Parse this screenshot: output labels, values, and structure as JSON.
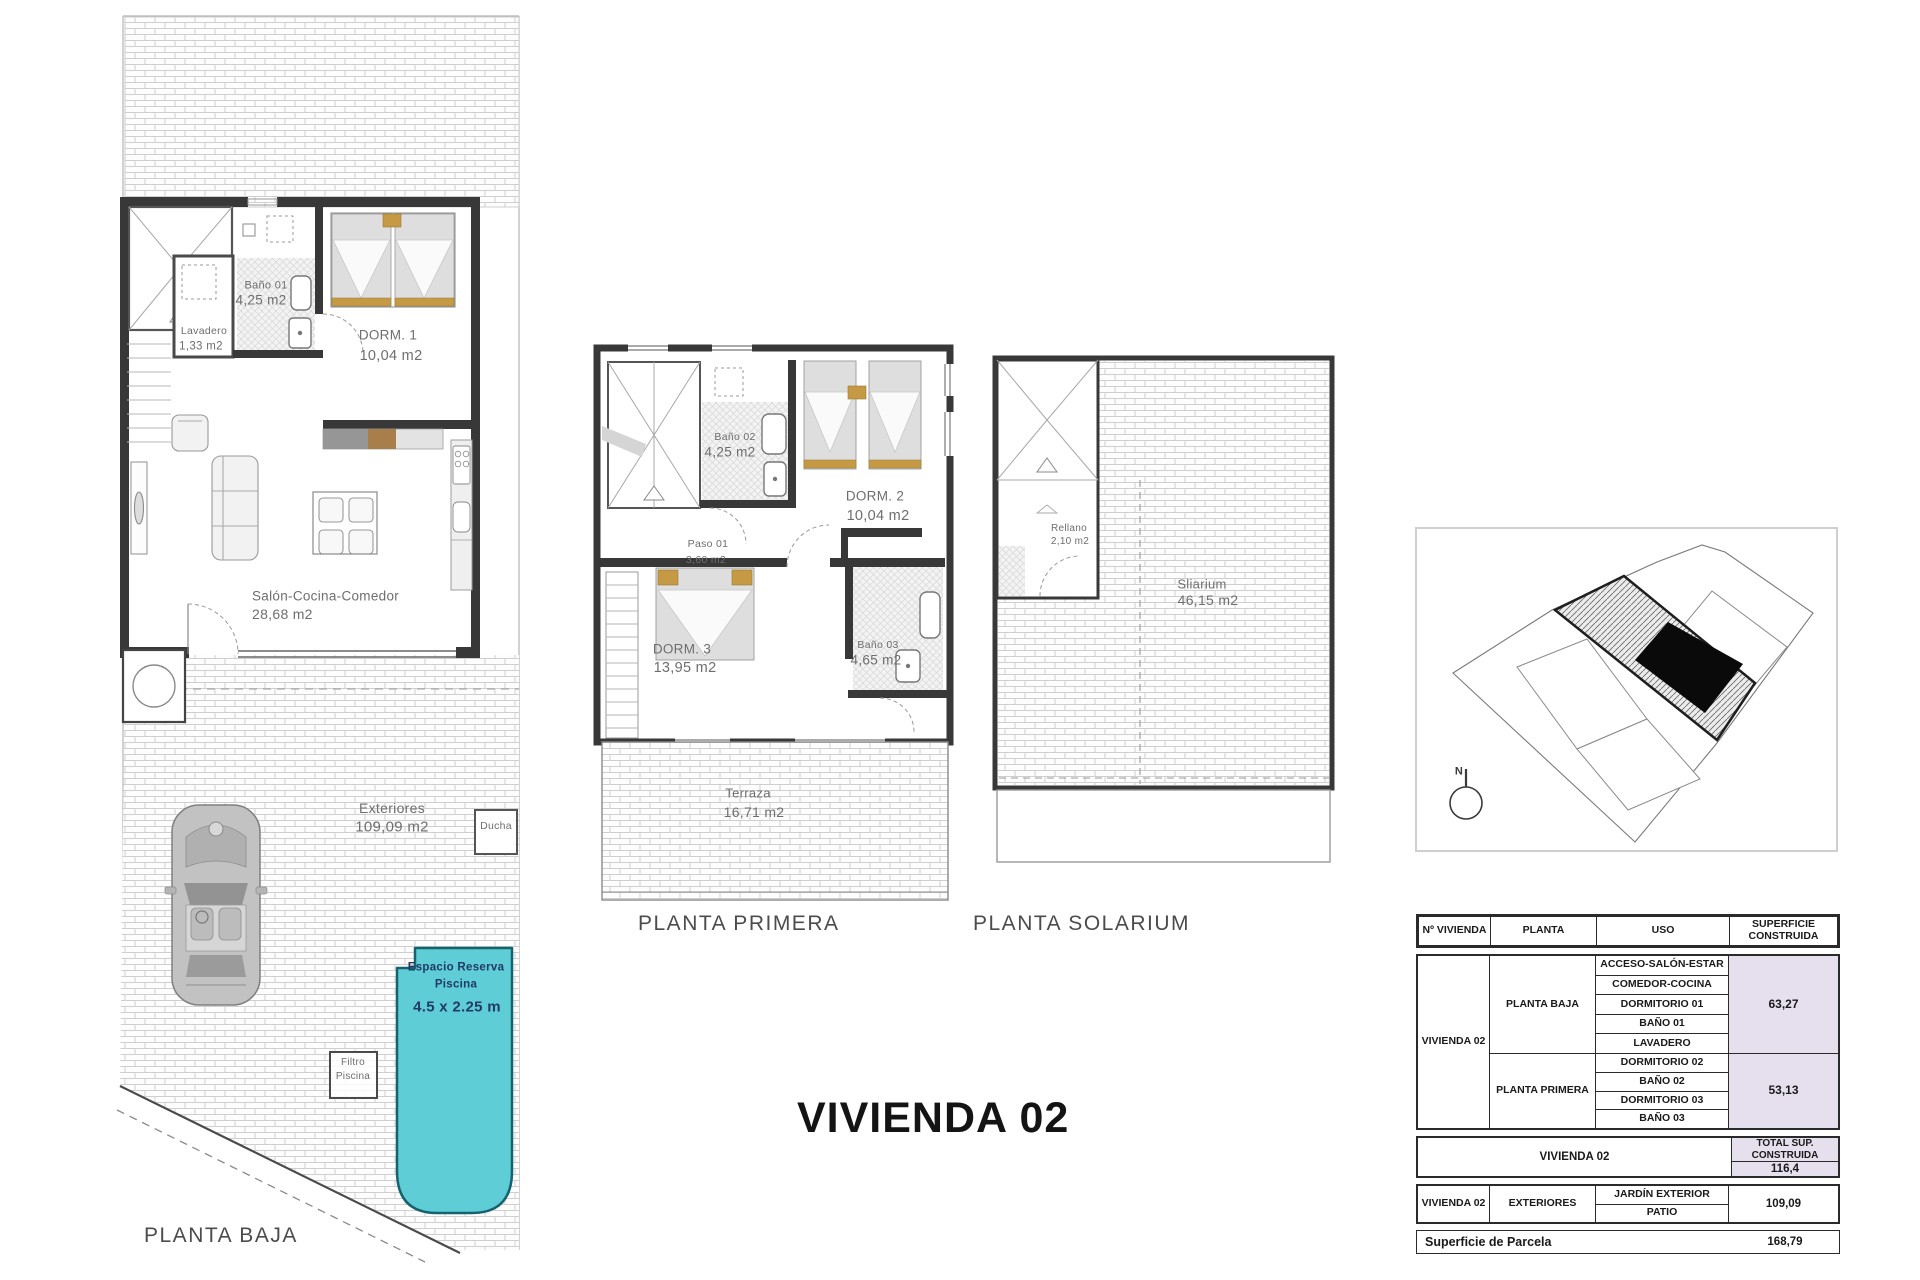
{
  "doc": {
    "main_title": "VIVIENDA 02"
  },
  "plans": {
    "planta_baja": {
      "title": "PLANTA BAJA",
      "rooms": {
        "lavadero": {
          "name": "Lavadero",
          "area": "1,33 m2"
        },
        "bano01": {
          "name": "Baño 01",
          "area": "4,25 m2"
        },
        "dorm1": {
          "name": "DORM. 1",
          "area": "10,04 m2"
        },
        "salon": {
          "name": "Salón-Cocina-Comedor",
          "area": "28,68 m2"
        },
        "exteriores": {
          "name": "Exteriores",
          "area": "109,09 m2"
        },
        "ducha": {
          "name": "Ducha"
        },
        "filtro": {
          "line1": "Filtro",
          "line2": "Piscina"
        },
        "piscina": {
          "line1": "Espacio Reserva",
          "line2": "Piscina",
          "line3": "4.5 x 2.25 m"
        }
      }
    },
    "planta_primera": {
      "title": "PLANTA PRIMERA",
      "rooms": {
        "bano02": {
          "name": "Baño 02",
          "area": "4,25 m2"
        },
        "dorm2": {
          "name": "DORM. 2",
          "area": "10,04 m2"
        },
        "paso01": {
          "name": "Paso 01",
          "area": "3,60 m2"
        },
        "dorm3": {
          "name": "DORM. 3",
          "area": "13,95 m2"
        },
        "bano03": {
          "name": "Baño 03",
          "area": "4,65 m2"
        },
        "terraza": {
          "name": "Terraza",
          "area": "16,71 m2"
        }
      }
    },
    "planta_solarium": {
      "title": "PLANTA SOLARIUM",
      "rooms": {
        "rellano": {
          "name": "Rellano",
          "area": "2,10 m2"
        },
        "solarium": {
          "name": "Sliarium",
          "area": "46,15 m2"
        }
      }
    }
  },
  "site_map": {
    "compass_label": "N"
  },
  "table": {
    "headers": {
      "col1": "Nº VIVIENDA",
      "col2": "PLANTA",
      "col3": "USO",
      "col4": "SUPERFICIE CONSTRUIDA"
    },
    "vivienda_label": "VIVIENDA 02",
    "planta_baja": {
      "planta": "PLANTA BAJA",
      "usos": [
        "ACCESO-SALÓN-ESTAR",
        "COMEDOR-COCINA",
        "DORMITORIO 01",
        "BAÑO 01",
        "LAVADERO"
      ],
      "superficie": "63,27"
    },
    "planta_primera": {
      "planta": "PLANTA PRIMERA",
      "usos": [
        "DORMITORIO 02",
        "BAÑO 02",
        "DORMITORIO 03",
        "BAÑO 03"
      ],
      "superficie": "53,13"
    },
    "total": {
      "label": "VIVIENDA 02",
      "header": "TOTAL SUP. CONSTRUIDA",
      "value": "116,4"
    },
    "exteriores": {
      "vivienda": "VIVIENDA 02",
      "planta": "EXTERIORES",
      "usos": [
        "JARDÍN EXTERIOR",
        "PATIO"
      ],
      "superficie": "109,09"
    },
    "parcela": {
      "label": "Superficie de Parcela",
      "value": "168,79"
    }
  },
  "colors": {
    "pool": "#5ecdd6",
    "pool_border": "#15636f",
    "wood_accent": "#c69a45",
    "table_highlight": "#e6dfed",
    "wall": "#383838"
  }
}
